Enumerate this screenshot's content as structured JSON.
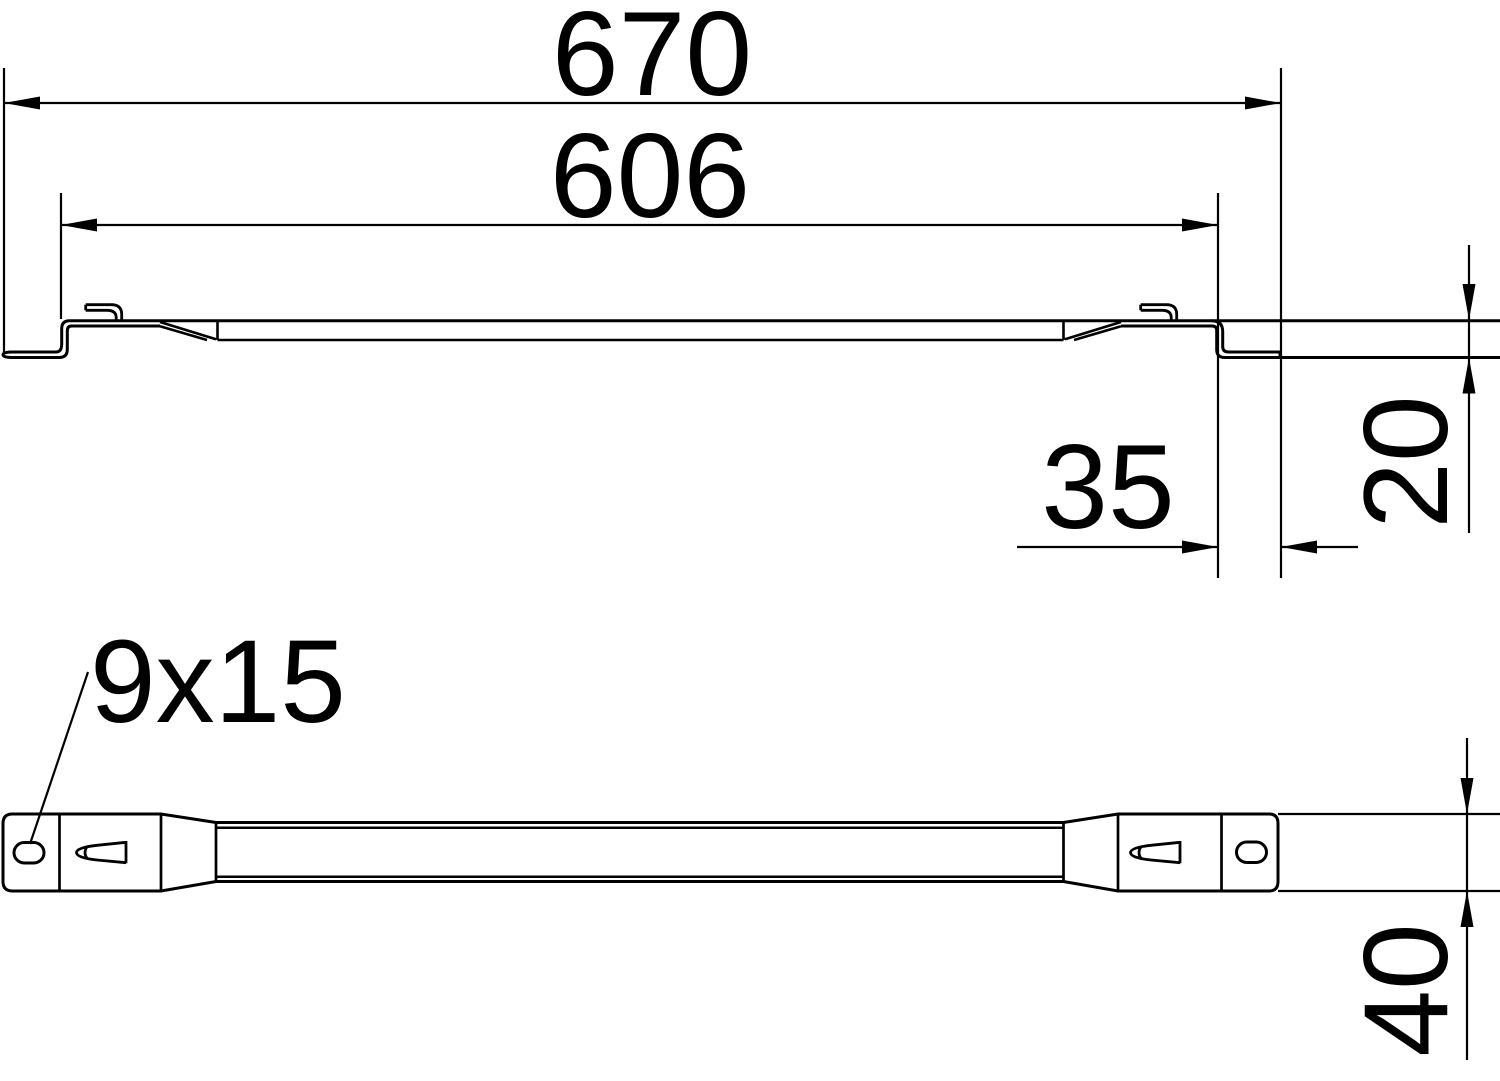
{
  "dims": {
    "overall_length": "670",
    "inner_length": "606",
    "end_flat_length": "35",
    "step_height": "20",
    "slot_size": "9x15",
    "profile_width": "40"
  },
  "colors": {
    "background": "#ffffff",
    "line": "#000000"
  }
}
